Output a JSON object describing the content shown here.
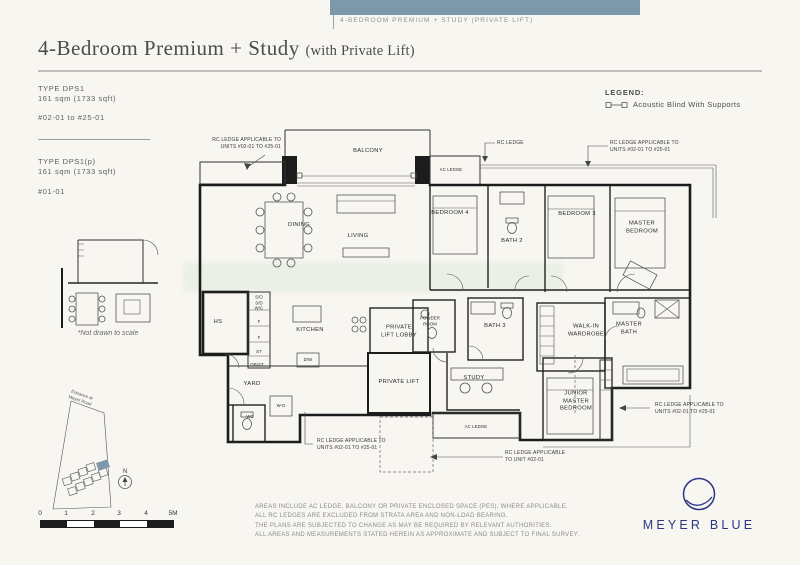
{
  "colors": {
    "banner_blue": "#7d98ab",
    "logo_navy": "#2b3685",
    "highlight_building": "#7d98ab"
  },
  "banner": {
    "label": "4-BEDROOM PREMIUM + STUDY (PRIVATE LIFT)"
  },
  "header": {
    "title": "4-Bedroom Premium + Study",
    "subtitle": "(with Private Lift)"
  },
  "unit_types": [
    {
      "type": "TYPE DPS1",
      "area": "161 sqm (1733 sqft)",
      "units": "#02-01 to #25-01"
    },
    {
      "type": "TYPE DPS1(p)",
      "area": "161 sqm (1733 sqft)",
      "units": "#01-01"
    }
  ],
  "legend": {
    "heading": "LEGEND:",
    "acoustic_blind": "Acoustic Blind With Supports"
  },
  "floorplan": {
    "rooms": {
      "balcony": "BALCONY",
      "dining": "DINING",
      "living": "LIVING",
      "bedroom4": "BEDROOM 4",
      "bath2": "BATH 2",
      "bedroom3": "BEDROOM 3",
      "master_bedroom": "MASTER\nBEDROOM",
      "ac_ledge_top": "AC LEDGE",
      "hs": "HS",
      "cabinet_stack": "S/O\nS/D\nW/C",
      "f1": "F",
      "f2": "F",
      "st": "ST",
      "obst": "OB/ST",
      "kitchen": "KITCHEN",
      "dw": "D/W",
      "yard": "YARD",
      "wc": "WC",
      "wd": "W-D",
      "private_lift_lobby": "PRIVATE\nLIFT LOBBY",
      "powder_room": "POWDER\nROOM",
      "private_lift": "PRIVATE LIFT",
      "bath3": "BATH 3",
      "study": "STUDY",
      "walk_in_wardrobe": "WALK-IN\nWARDROBE",
      "master_bath": "MASTER\nBATH",
      "junior_master": "JUNIOR\nMASTER\nBEDROOM",
      "ac_ledge_bottom": "AC LEDGE"
    },
    "annotations": {
      "rc_top_left": "RC LEDGE APPLICABLE TO\nUNITS #02-01 TO #25-01",
      "rc_top_mid": "RC LEDGE",
      "rc_top_right": "RC LEDGE APPLICABLE TO\nUNITS #02-01 TO #25-01",
      "rc_bottom_left": "RC LEDGE APPLICABLE TO\nUNITS #02-01 TO #25-01",
      "rc_bottom_mid": "RC LEDGE APPLICABLE\nTO UNIT #02-01",
      "rc_right": "RC LEDGE APPLICABLE TO\nUNITS #02-01 TO #25-01"
    }
  },
  "thumbnail": {
    "note": "*Not drawn to scale"
  },
  "site_plan": {
    "entrance": "Entrance at\nMeyer Road",
    "north": "N"
  },
  "scale_bar": {
    "labels": [
      "0",
      "1",
      "2",
      "3",
      "4",
      "5M"
    ]
  },
  "disclaimer": {
    "lines": [
      "AREAS INCLUDE AC LEDGE, BALCONY OR PRIVATE ENCLOSED SPACE (PES), WHERE APPLICABLE.",
      "ALL RC LEDGES ARE EXCLUDED FROM STRATA AREA AND NON-LOAD BEARING.",
      "THE PLANS ARE SUBJECTED TO CHANGE AS MAY BE REQUIRED BY RELEVANT AUTHORITIES.",
      "ALL AREAS AND MEASUREMENTS STATED HEREIN AS APPROXIMATE AND SUBJECT TO FINAL SURVEY."
    ]
  },
  "logo": {
    "name": "MEYER BLUE"
  }
}
